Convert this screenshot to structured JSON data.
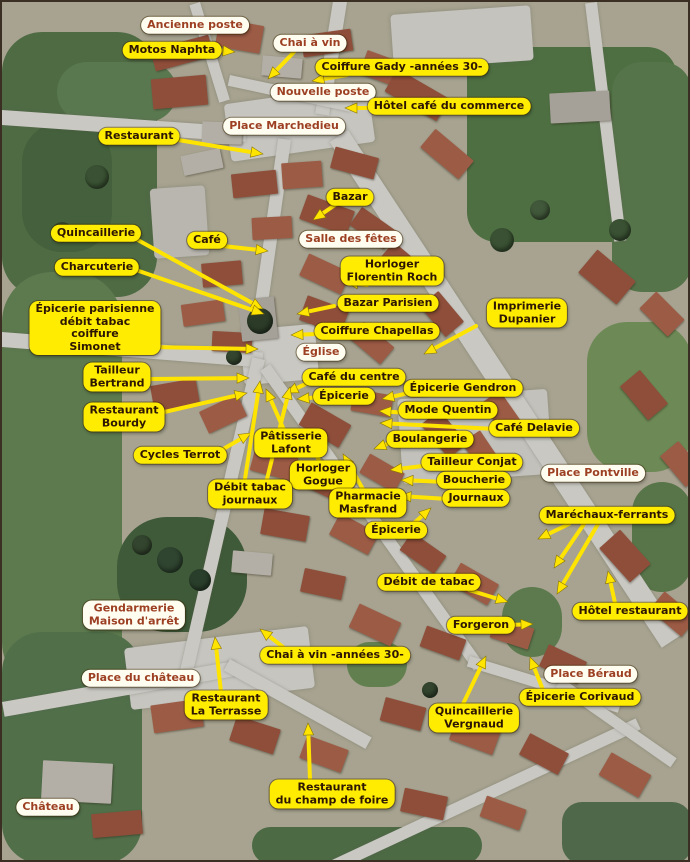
{
  "colors": {
    "label_yellow_bg": "#ffec00",
    "label_white_bg": "#fffdf0",
    "label_yellow_text": "#2d1602",
    "label_white_text": "#9c3f22",
    "arrow": "#ffe400",
    "arrow_edge": "#8a7500"
  },
  "labels": [
    {
      "id": "ancienne-poste",
      "text": "Ancienne poste",
      "style": "white",
      "cx": 193,
      "cy": 23,
      "arrows": []
    },
    {
      "id": "motos-naphta",
      "text": "Motos Naphta",
      "style": "yellow",
      "cx": 170,
      "cy": 48,
      "arrows": [
        [
          213,
          48,
          233,
          50
        ]
      ]
    },
    {
      "id": "chai-a-vin",
      "text": "Chai à vin",
      "style": "white",
      "cx": 308,
      "cy": 41,
      "arrows": [
        [
          292,
          50,
          266,
          77
        ]
      ]
    },
    {
      "id": "coiffure-gady",
      "text": "Coiffure Gady -années 30-",
      "style": "yellow",
      "cx": 400,
      "cy": 65,
      "arrows": [
        [
          345,
          73,
          310,
          79
        ]
      ]
    },
    {
      "id": "nouvelle-poste",
      "text": "Nouvelle poste",
      "style": "white",
      "cx": 321,
      "cy": 90,
      "arrows": []
    },
    {
      "id": "hotel-cafe-du-commerce",
      "text": "Hôtel café du commerce",
      "style": "yellow",
      "cx": 447,
      "cy": 104,
      "arrows": [
        [
          378,
          106,
          343,
          106
        ]
      ]
    },
    {
      "id": "place-marchedieu",
      "text": "Place Marchedieu",
      "style": "white",
      "cx": 282,
      "cy": 124,
      "arrows": []
    },
    {
      "id": "restaurant-nord",
      "text": "Restaurant",
      "style": "yellow",
      "cx": 137,
      "cy": 134,
      "arrows": [
        [
          170,
          137,
          261,
          152
        ]
      ]
    },
    {
      "id": "bazar",
      "text": "Bazar",
      "style": "yellow",
      "cx": 348,
      "cy": 195,
      "arrows": [
        [
          333,
          203,
          311,
          218
        ]
      ]
    },
    {
      "id": "quincaillerie",
      "text": "Quincaillerie",
      "style": "yellow",
      "cx": 94,
      "cy": 231,
      "arrows": [
        [
          134,
          237,
          261,
          307
        ]
      ]
    },
    {
      "id": "cafe",
      "text": "Café",
      "style": "yellow",
      "cx": 205,
      "cy": 238,
      "arrows": [
        [
          221,
          244,
          266,
          249
        ]
      ]
    },
    {
      "id": "salle-des-fetes",
      "text": "Salle des fêtes",
      "style": "white",
      "cx": 349,
      "cy": 237,
      "arrows": []
    },
    {
      "id": "charcuterie",
      "text": "Charcuterie",
      "style": "yellow",
      "cx": 95,
      "cy": 265,
      "arrows": [
        [
          134,
          268,
          262,
          312
        ]
      ]
    },
    {
      "id": "horloger-florentin-roch",
      "text": "Horloger\nFlorentin Roch",
      "style": "yellow",
      "cx": 390,
      "cy": 269,
      "arrows": [
        [
          365,
          283,
          344,
          280
        ]
      ]
    },
    {
      "id": "bazar-parisien",
      "text": "Bazar Parisien",
      "style": "yellow",
      "cx": 386,
      "cy": 301,
      "arrows": [
        [
          332,
          304,
          295,
          312
        ]
      ]
    },
    {
      "id": "imprimerie-dupanier",
      "text": "Imprimerie\nDupanier",
      "style": "yellow",
      "cx": 525,
      "cy": 311,
      "arrows": [
        [
          474,
          324,
          422,
          352
        ]
      ]
    },
    {
      "id": "epicerie-parisienne-simonet",
      "text": "Épicerie parisienne\ndébit tabac\ncoiffure\nSimonet",
      "style": "yellow",
      "cx": 93,
      "cy": 326,
      "arrows": [
        [
          149,
          345,
          256,
          347
        ]
      ]
    },
    {
      "id": "coiffure-chapellas",
      "text": "Coiffure Chapellas",
      "style": "yellow",
      "cx": 375,
      "cy": 329,
      "arrows": [
        [
          315,
          332,
          289,
          333
        ]
      ]
    },
    {
      "id": "eglise",
      "text": "Église",
      "style": "white",
      "cx": 319,
      "cy": 350,
      "arrows": []
    },
    {
      "id": "tailleur-bertrand",
      "text": "Tailleur\nBertrand",
      "style": "yellow",
      "cx": 115,
      "cy": 375,
      "arrows": [
        [
          147,
          377,
          247,
          376
        ]
      ]
    },
    {
      "id": "cafe-du-centre",
      "text": "Café du centre",
      "style": "yellow",
      "cx": 352,
      "cy": 375,
      "arrows": [
        [
          308,
          380,
          284,
          391
        ]
      ]
    },
    {
      "id": "epicerie-gendron",
      "text": "Épicerie Gendron",
      "style": "yellow",
      "cx": 461,
      "cy": 386,
      "arrows": [
        [
          411,
          390,
          380,
          397
        ]
      ]
    },
    {
      "id": "epicerie-centre",
      "text": "Épicerie",
      "style": "yellow",
      "cx": 342,
      "cy": 394,
      "arrows": [
        [
          318,
          395,
          295,
          397
        ]
      ]
    },
    {
      "id": "mode-quentin",
      "text": "Mode Quentin",
      "style": "yellow",
      "cx": 446,
      "cy": 408,
      "arrows": [
        [
          406,
          411,
          377,
          409
        ]
      ]
    },
    {
      "id": "restaurant-bourdy",
      "text": "Restaurant\nBourdy",
      "style": "yellow",
      "cx": 122,
      "cy": 415,
      "arrows": [
        [
          158,
          411,
          245,
          391
        ]
      ]
    },
    {
      "id": "boulangerie",
      "text": "Boulangerie",
      "style": "yellow",
      "cx": 428,
      "cy": 437,
      "arrows": [
        [
          393,
          439,
          372,
          447
        ]
      ]
    },
    {
      "id": "cafe-delavie",
      "text": "Café Delavie",
      "style": "yellow",
      "cx": 532,
      "cy": 426,
      "arrows": [
        [
          494,
          427,
          378,
          421
        ]
      ]
    },
    {
      "id": "cycles-terrot",
      "text": "Cycles Terrot",
      "style": "yellow",
      "cx": 178,
      "cy": 453,
      "arrows": [
        [
          216,
          450,
          249,
          431
        ]
      ]
    },
    {
      "id": "patisserie-lafont",
      "text": "Pâtisserie\nLafont",
      "style": "yellow",
      "cx": 289,
      "cy": 441,
      "arrows": [
        [
          282,
          428,
          264,
          387
        ]
      ]
    },
    {
      "id": "tailleur-conjat",
      "text": "Tailleur Conjat",
      "style": "yellow",
      "cx": 470,
      "cy": 460,
      "arrows": [
        [
          429,
          463,
          388,
          468
        ]
      ]
    },
    {
      "id": "horloger-gogue",
      "text": "Horloger\nGogue",
      "style": "yellow",
      "cx": 321,
      "cy": 473,
      "arrows": [
        [
          318,
          461,
          303,
          428
        ]
      ]
    },
    {
      "id": "boucherie",
      "text": "Boucherie",
      "style": "yellow",
      "cx": 472,
      "cy": 478,
      "arrows": [
        [
          443,
          480,
          399,
          478
        ]
      ]
    },
    {
      "id": "place-pontville",
      "text": "Place Pontville",
      "style": "white",
      "cx": 591,
      "cy": 471,
      "arrows": []
    },
    {
      "id": "debit-tabac-journaux",
      "text": "Débit tabac\njournaux",
      "style": "yellow",
      "cx": 248,
      "cy": 492,
      "arrows": [
        [
          243,
          477,
          258,
          379
        ],
        [
          265,
          477,
          288,
          385
        ]
      ]
    },
    {
      "id": "journaux",
      "text": "Journaux",
      "style": "yellow",
      "cx": 474,
      "cy": 496,
      "arrows": [
        [
          446,
          497,
          397,
          494
        ]
      ]
    },
    {
      "id": "pharmacie-masfrand",
      "text": "Pharmacie\nMasfrand",
      "style": "yellow",
      "cx": 366,
      "cy": 501,
      "arrows": [
        [
          362,
          489,
          341,
          452
        ]
      ]
    },
    {
      "id": "marechaux-ferrants",
      "text": "Maréchaux-ferrants",
      "style": "yellow",
      "cx": 605,
      "cy": 513,
      "arrows": [
        [
          567,
          522,
          536,
          537
        ],
        [
          582,
          522,
          552,
          566
        ],
        [
          596,
          522,
          555,
          592
        ]
      ]
    },
    {
      "id": "epicerie-sud",
      "text": "Épicerie",
      "style": "yellow",
      "cx": 394,
      "cy": 528,
      "arrows": [
        [
          411,
          522,
          429,
          506
        ]
      ]
    },
    {
      "id": "debit-de-tabac",
      "text": "Débit de tabac",
      "style": "yellow",
      "cx": 427,
      "cy": 580,
      "arrows": [
        [
          467,
          588,
          506,
          600
        ]
      ]
    },
    {
      "id": "hotel-restaurant",
      "text": "Hôtel restaurant",
      "style": "yellow",
      "cx": 628,
      "cy": 609,
      "arrows": [
        [
          613,
          601,
          606,
          569
        ]
      ]
    },
    {
      "id": "gendarmerie",
      "text": "Gendarmerie\nMaison d'arrêt",
      "style": "white",
      "cx": 132,
      "cy": 613,
      "arrows": []
    },
    {
      "id": "forgeron",
      "text": "Forgeron",
      "style": "yellow",
      "cx": 479,
      "cy": 623,
      "arrows": [
        [
          508,
          623,
          531,
          622
        ]
      ]
    },
    {
      "id": "chai-a-vin-annees-30",
      "text": "Chai à vin -années 30-",
      "style": "yellow",
      "cx": 333,
      "cy": 653,
      "arrows": [
        [
          281,
          645,
          258,
          627
        ]
      ]
    },
    {
      "id": "place-beraud",
      "text": "Place Béraud",
      "style": "white",
      "cx": 589,
      "cy": 672,
      "arrows": []
    },
    {
      "id": "place-du-chateau",
      "text": "Place du château",
      "style": "white",
      "cx": 139,
      "cy": 676,
      "arrows": []
    },
    {
      "id": "restaurant-la-terrasse",
      "text": "Restaurant\nLa Terrasse",
      "style": "yellow",
      "cx": 224,
      "cy": 703,
      "arrows": [
        [
          219,
          690,
          213,
          635
        ]
      ]
    },
    {
      "id": "epicerie-corivaud",
      "text": "Épicerie Corivaud",
      "style": "yellow",
      "cx": 578,
      "cy": 695,
      "arrows": [
        [
          541,
          688,
          528,
          655
        ]
      ]
    },
    {
      "id": "quincaillerie-vergnaud",
      "text": "Quincaillerie\nVergnaud",
      "style": "yellow",
      "cx": 472,
      "cy": 716,
      "arrows": [
        [
          461,
          702,
          484,
          654
        ]
      ]
    },
    {
      "id": "chateau",
      "text": "Château",
      "style": "white",
      "cx": 46,
      "cy": 805,
      "arrows": []
    },
    {
      "id": "restaurant-champ-de-foire",
      "text": "Restaurant\ndu champ de foire",
      "style": "yellow",
      "cx": 330,
      "cy": 792,
      "arrows": [
        [
          308,
          778,
          306,
          721
        ]
      ]
    }
  ]
}
